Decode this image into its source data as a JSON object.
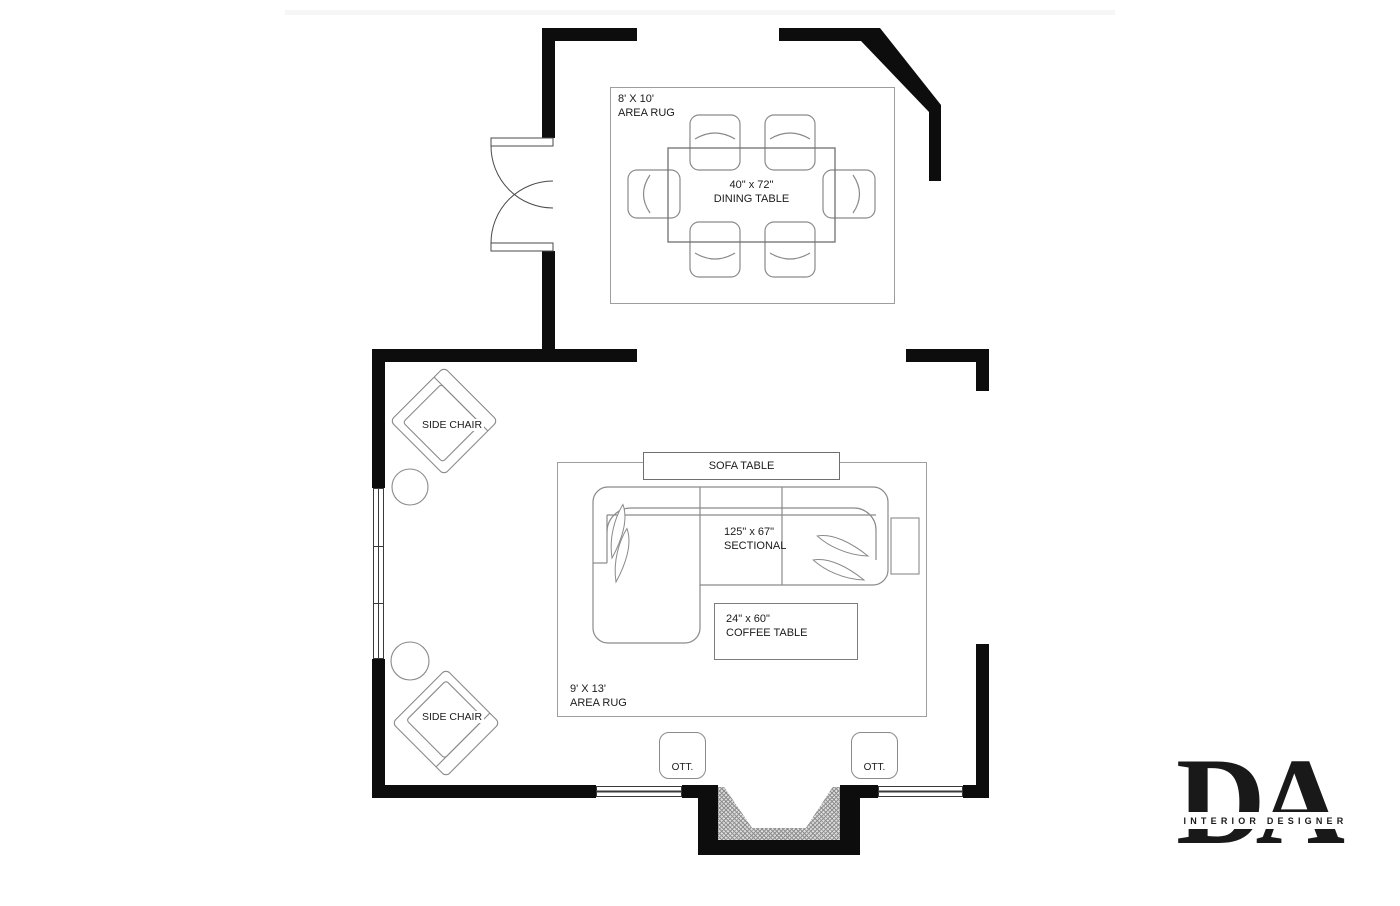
{
  "plan": {
    "dining": {
      "rug": {
        "size": "8' X 10'",
        "type": "AREA RUG"
      },
      "table": {
        "size": "40\" x 72\"",
        "name": "DINING TABLE"
      }
    },
    "living": {
      "sofa_table_label": "SOFA TABLE",
      "sectional": {
        "size": "125\" x 67\"",
        "name": "SECTIONAL"
      },
      "coffee_table": {
        "size": "24\" x 60\"",
        "name": "COFFEE TABLE"
      },
      "rug": {
        "size": "9' X 13'",
        "type": "AREA RUG"
      },
      "side_chair_label": "SIDE CHAIR",
      "ottoman_label": "OTT."
    }
  },
  "logo": {
    "monogram": "DA",
    "tagline": "INTERIOR DESIGNER"
  },
  "colors": {
    "wall": "#0d0d0d",
    "furniture_line": "#8a8a8a",
    "rug_border": "#9e9e9e",
    "text": "#1b1b1b",
    "hatch": "#8f8f8f"
  }
}
